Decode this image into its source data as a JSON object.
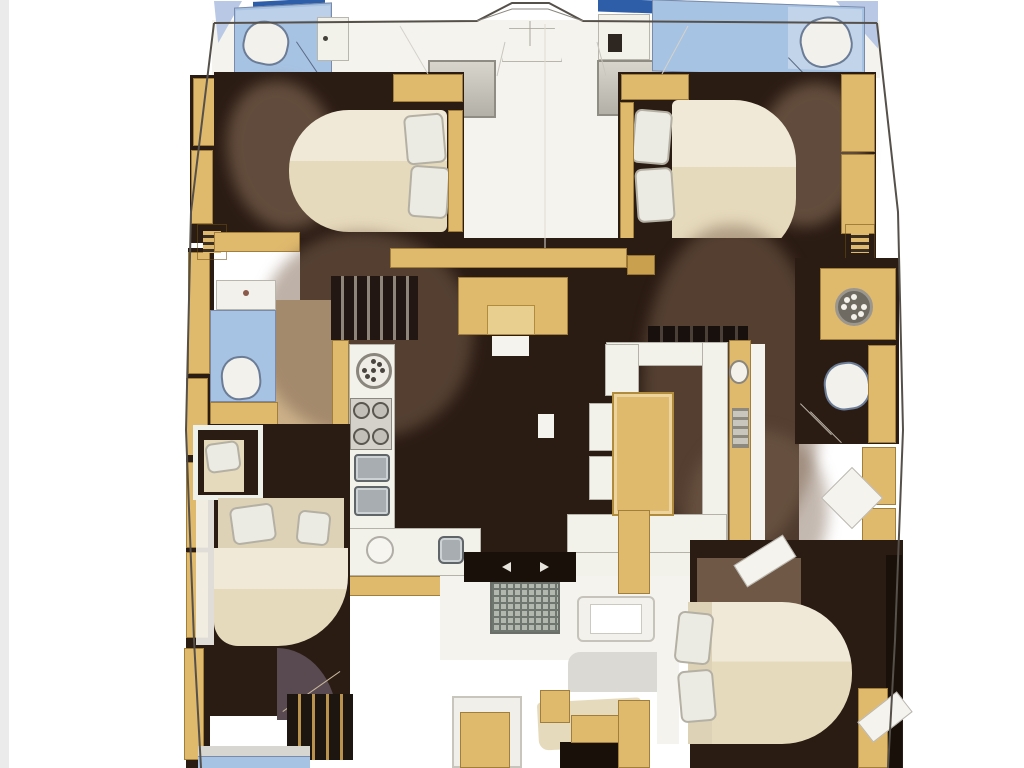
{
  "title": "Catamaran yacht interior layout floor plan, top-down view",
  "palette": {
    "bg": "#ffffff",
    "edge": "#ebebeb",
    "deck": "#f4f3ee",
    "counter": "#f2f1ea",
    "floor": "#2a1b13",
    "floorDeep": "#181009",
    "wood": "#dfb96c",
    "woodDark": "#c9a04e",
    "woodLight": "#e8cf8f",
    "bed": "#e6dabc",
    "bedHead": "#ded2b6",
    "pillow": "#ecebe3",
    "bath": "#a7c3e3",
    "bathLight": "#c2d4ea",
    "navy": "#2f5ea8",
    "sky": "#b9c8e4",
    "shadow": "#7d6450",
    "carpet": "#6f5846",
    "arcDoor": "#584a50",
    "steel": "#a7adb0",
    "panel": "#c9c6be",
    "toilet": "#f2f1ec",
    "stove": "#d3d1ca",
    "seatGray": "#dbd9d3",
    "stepTanLight": "#ddd3c0",
    "outline": "#55504a"
  },
  "rooms": [
    {
      "name": "bow-deck"
    },
    {
      "name": "port-forward-head"
    },
    {
      "name": "starboard-forward-head"
    },
    {
      "name": "port-forward-cabin"
    },
    {
      "name": "starboard-forward-cabin"
    },
    {
      "name": "galley"
    },
    {
      "name": "salon-dinette"
    },
    {
      "name": "port-mid-head"
    },
    {
      "name": "port-aft-cabin"
    },
    {
      "name": "starboard-aft-head"
    },
    {
      "name": "starboard-aft-cabin"
    },
    {
      "name": "cockpit-entry"
    }
  ],
  "fixtures": [
    {
      "name": "toilet",
      "count": 3
    },
    {
      "name": "wash-basin",
      "count": 2
    },
    {
      "name": "round-sink",
      "count": 3
    },
    {
      "name": "stove-4-burner",
      "count": 1
    },
    {
      "name": "double-sink-unit",
      "count": 2
    },
    {
      "name": "dining-table",
      "count": 1
    },
    {
      "name": "u-shaped-sofa",
      "count": 1
    },
    {
      "name": "double-bed",
      "count": 4
    },
    {
      "name": "single-berth",
      "count": 1
    },
    {
      "name": "companionway-steps",
      "count": 2
    },
    {
      "name": "cockpit-doormat",
      "count": 1
    },
    {
      "name": "door-swing",
      "count": 1
    },
    {
      "name": "deck-locker",
      "count": 2
    }
  ]
}
